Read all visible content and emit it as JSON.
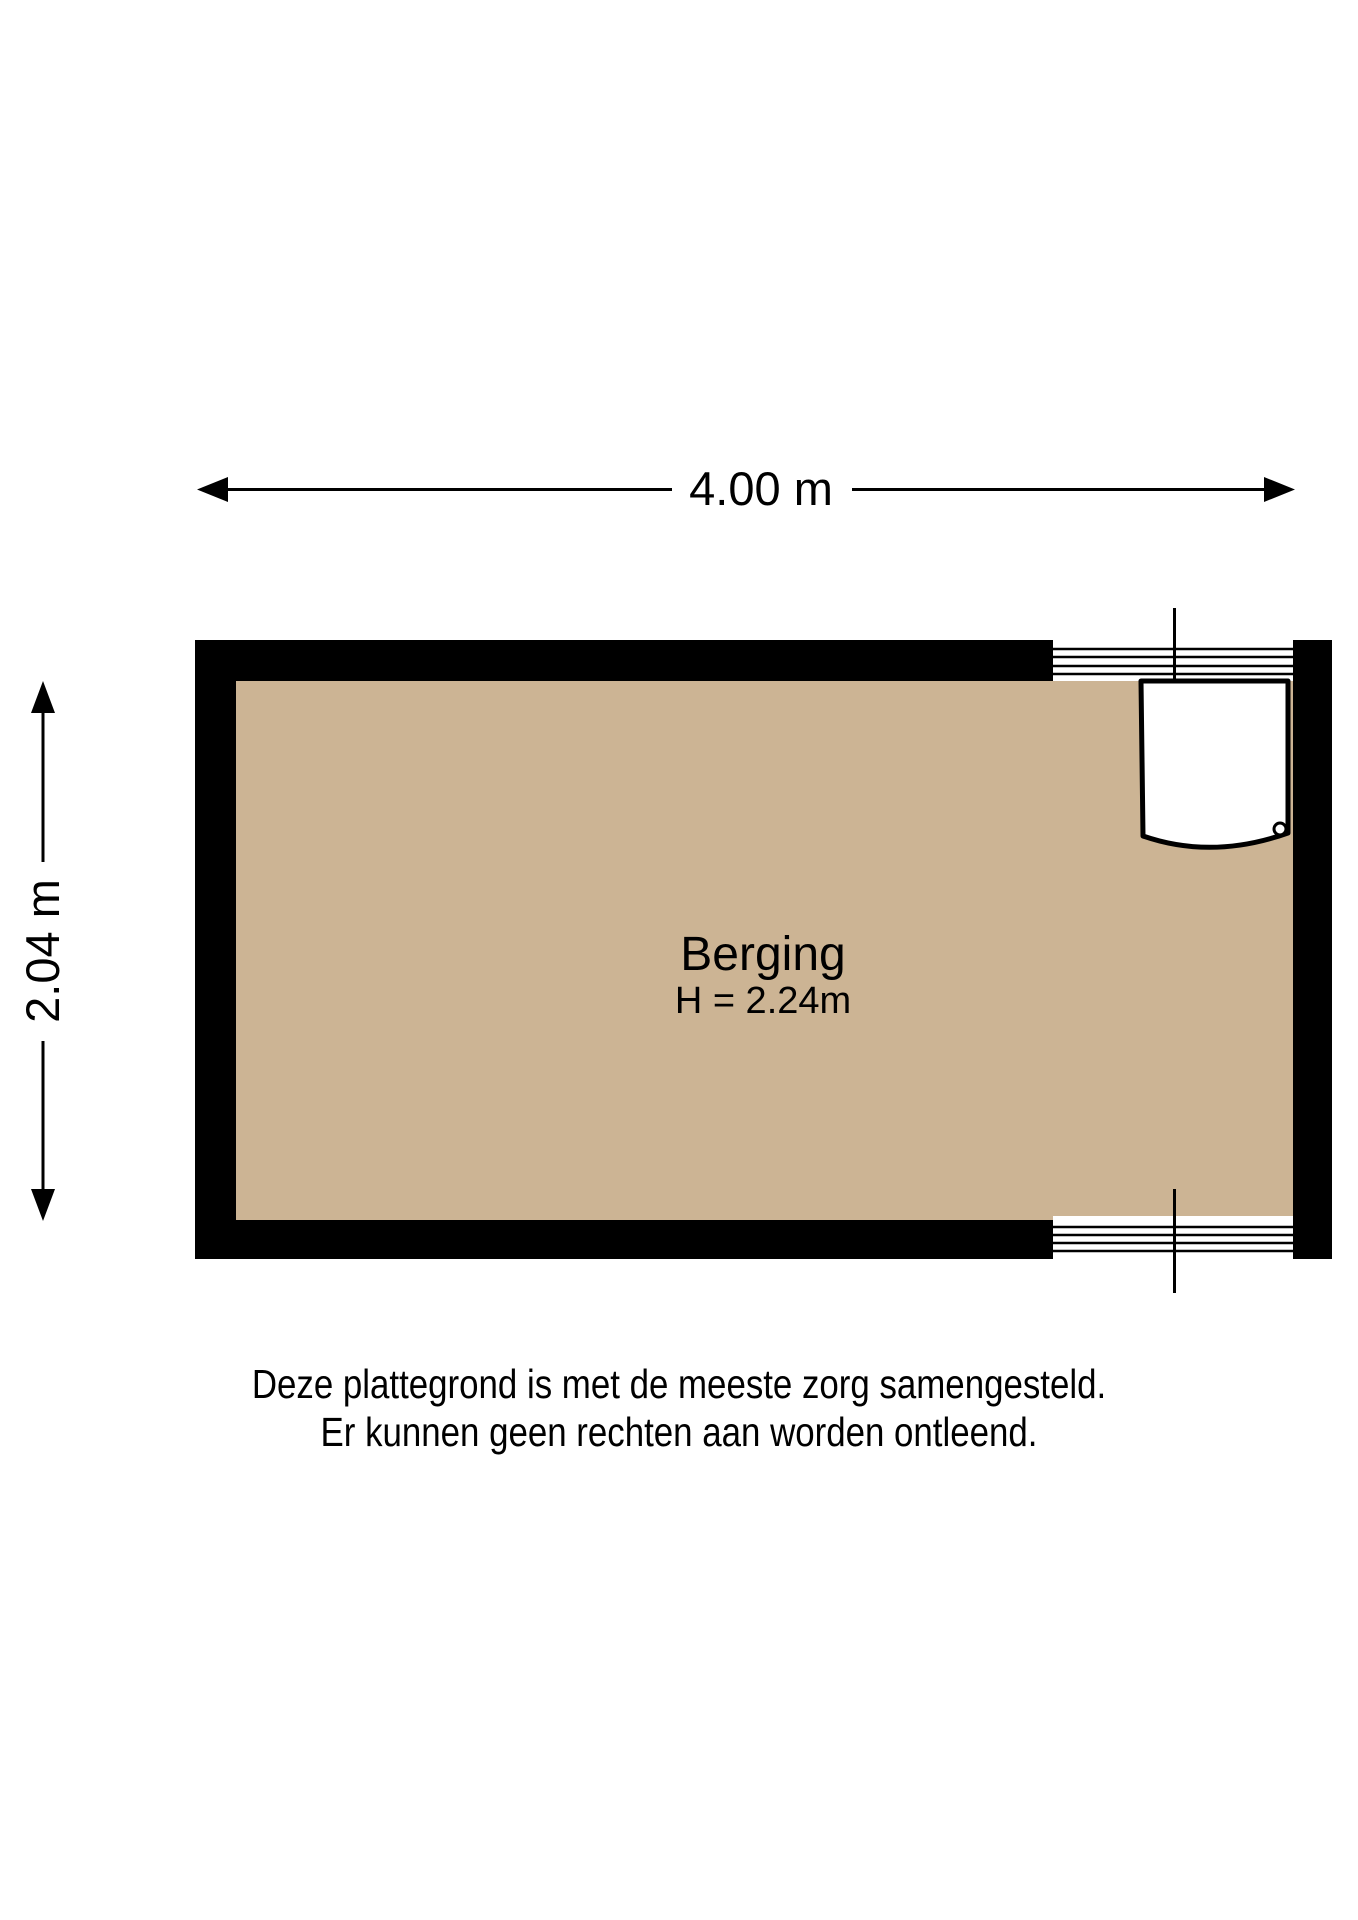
{
  "page": {
    "background_color": "#ffffff"
  },
  "dimensions": {
    "width_label": "4.00 m",
    "height_label": "2.04 m"
  },
  "room": {
    "name": "Berging",
    "height_label": "H = 2.24m",
    "floor_color": "#ccb494",
    "wall_color": "#000000"
  },
  "disclaimer": {
    "line1": "Deze plattegrond is met de meeste zorg samengesteld.",
    "line2": "Er kunnen geen rechten aan worden ontleend."
  }
}
